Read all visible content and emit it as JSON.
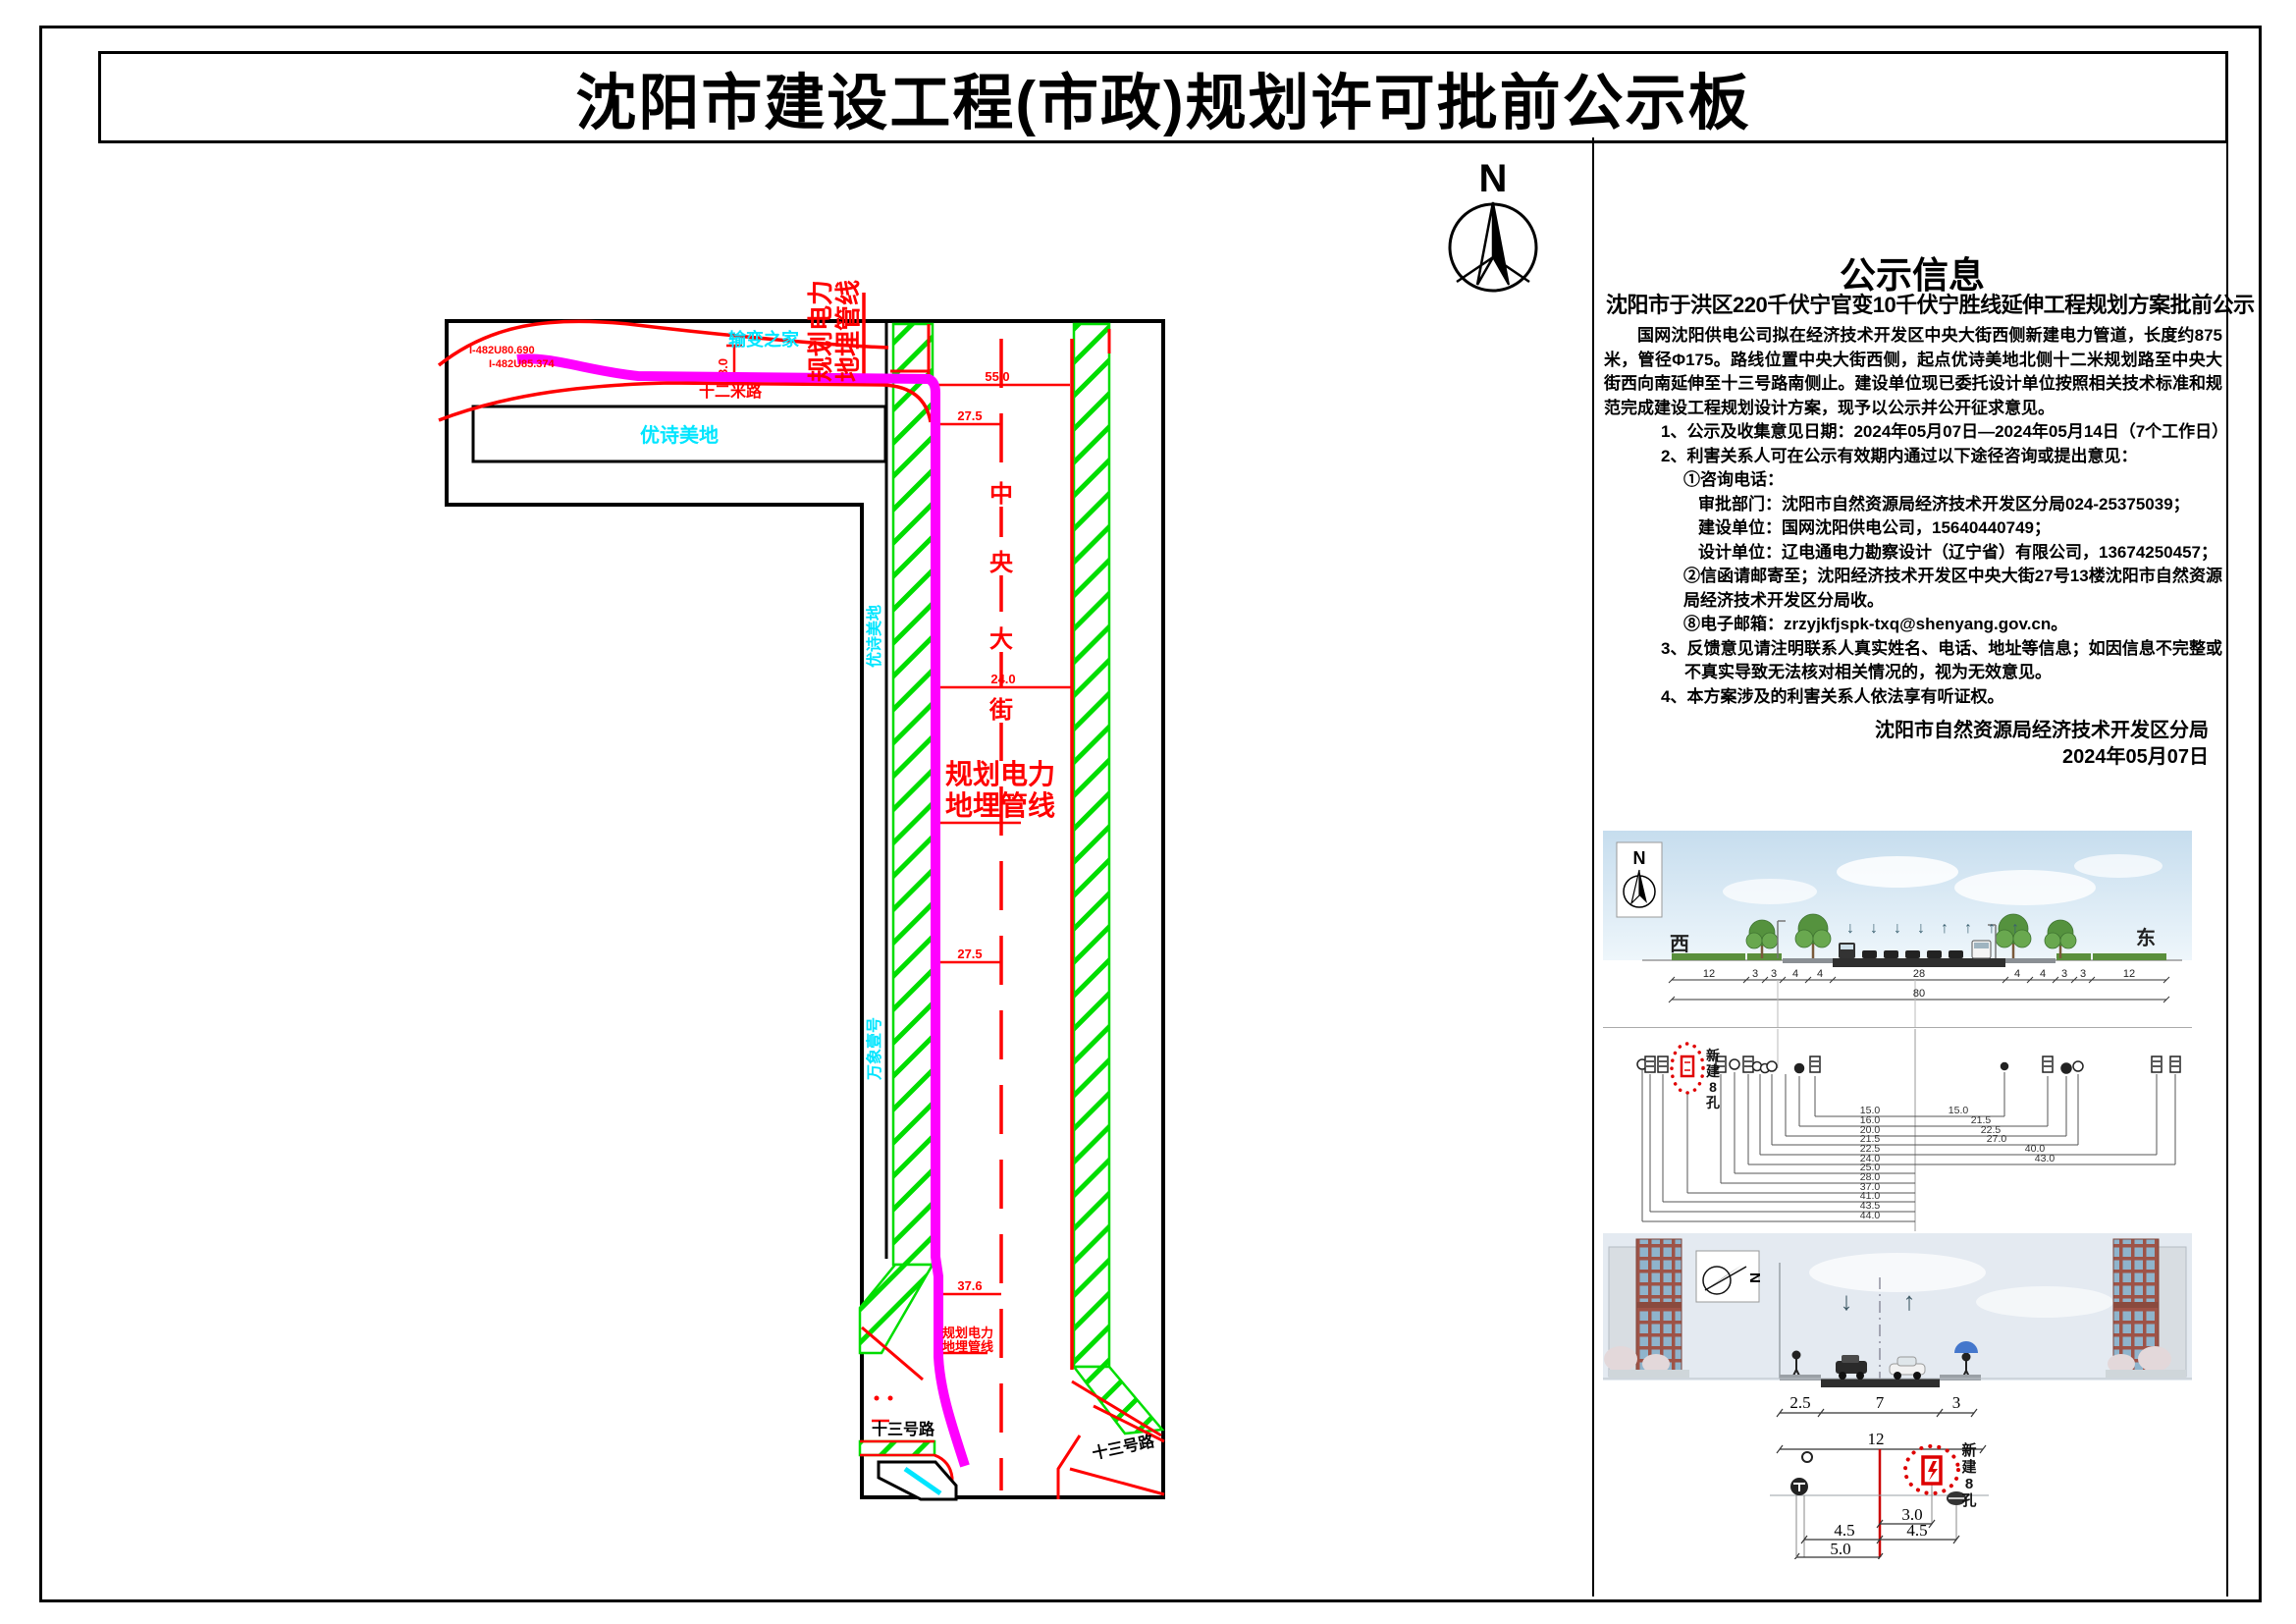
{
  "page": {
    "title": "沈阳市建设工程(市政)规划许可批前公示板"
  },
  "notice": {
    "heading": "公示信息",
    "subtitle": "沈阳市于洪区220千伏宁官变10千伏宁胜线延伸工程规划方案批前公示",
    "para_intro": "国网沈阳供电公司拟在经济技术开发区中央大街西侧新建电力管道，长度约875米，管径Φ175。路线位置中央大街西侧，起点优诗美地北侧十二米规划路至中央大街西向南延伸至十三号路南侧止。建设单位现已委托设计单位按照相关技术标准和规范完成建设工程规划设计方案，现予以公示并公开征求意见。",
    "item1": "1、公示及收集意见日期：2024年05月07日—2024年05月14日（7个工作日）",
    "item2": "2、利害关系人可在公示有效期内通过以下途径咨询或提出意见：",
    "channel_phone_title": "①咨询电话：",
    "phone_approval": "审批部门：沈阳市自然资源局经济技术开发区分局024-25375039；",
    "phone_builder": "建设单位：国网沈阳供电公司，15640440749；",
    "phone_designer": "设计单位：辽电通电力勘察设计（辽宁省）有限公司，13674250457；",
    "channel_mail": "②信函请邮寄至；沈阳经济技术开发区中央大街27号13楼沈阳市自然资源局经济技术开发区分局收。",
    "channel_email": "⑧电子邮箱：zrzyjkfjspk-txq@shenyang.gov.cn。",
    "item3": "3、反馈意见请注明联系人真实姓名、电话、地址等信息；如因信息不完整或不真实导致无法核对相关情况的，视为无效意见。",
    "item4": "4、本方案涉及的利害关系人依法享有听证权。",
    "signature": "沈阳市自然资源局经济技术开发区分局",
    "date": "2024年05月07日"
  },
  "map": {
    "north": "N",
    "estate_top": "输变之家",
    "estate_rect": "优诗美地",
    "road_12m": "十二米路",
    "street_chars": [
      "中",
      "央",
      "大",
      "街"
    ],
    "route_line1": "规划电力",
    "route_line2": "地埋管线",
    "side_estate_upper": "优诗美地",
    "side_estate_lower": "万象壹号",
    "road_13_left": "十三号路",
    "road_13_right": "十三号路",
    "coord_a": "I-482U80.690",
    "coord_b": "I-482U85.374",
    "dim_3": "3.0",
    "dim_55": "55.0",
    "dim_275a": "27.5",
    "dim_24": "24.0",
    "dim_275b": "27.5",
    "dim_376": "37.6",
    "colors": {
      "route": "#ff00ff",
      "green": "#00dd00",
      "red": "#ff0000",
      "cyan": "#00e5ff"
    }
  },
  "cross_section": {
    "north": "N",
    "west": "西",
    "east": "东",
    "dims": [
      "12",
      "3",
      "3",
      "4",
      "4",
      "28",
      "4",
      "4",
      "3",
      "3",
      "12"
    ],
    "total": "80"
  },
  "utility_section": {
    "new_duct_chars": [
      "新",
      "建",
      "8",
      "孔"
    ],
    "left_dims": [
      "15.0",
      "16.0",
      "20.0",
      "21.5",
      "22.5",
      "24.0",
      "25.0",
      "28.0",
      "37.0",
      "41.0",
      "43.5",
      "44.0"
    ],
    "right_dims": [
      "15.0",
      "21.5",
      "22.5",
      "27.0",
      "40.0",
      "43.0"
    ]
  },
  "street_section": {
    "north": "N",
    "dims_top": [
      "2.5",
      "7",
      "3"
    ],
    "dim_12": "12",
    "new_duct_chars": [
      "新",
      "建",
      "8",
      "孔"
    ],
    "dim_3_0": "3.0",
    "dim_45a": "4.5",
    "dim_45b": "4.5",
    "dim_50": "5.0"
  }
}
